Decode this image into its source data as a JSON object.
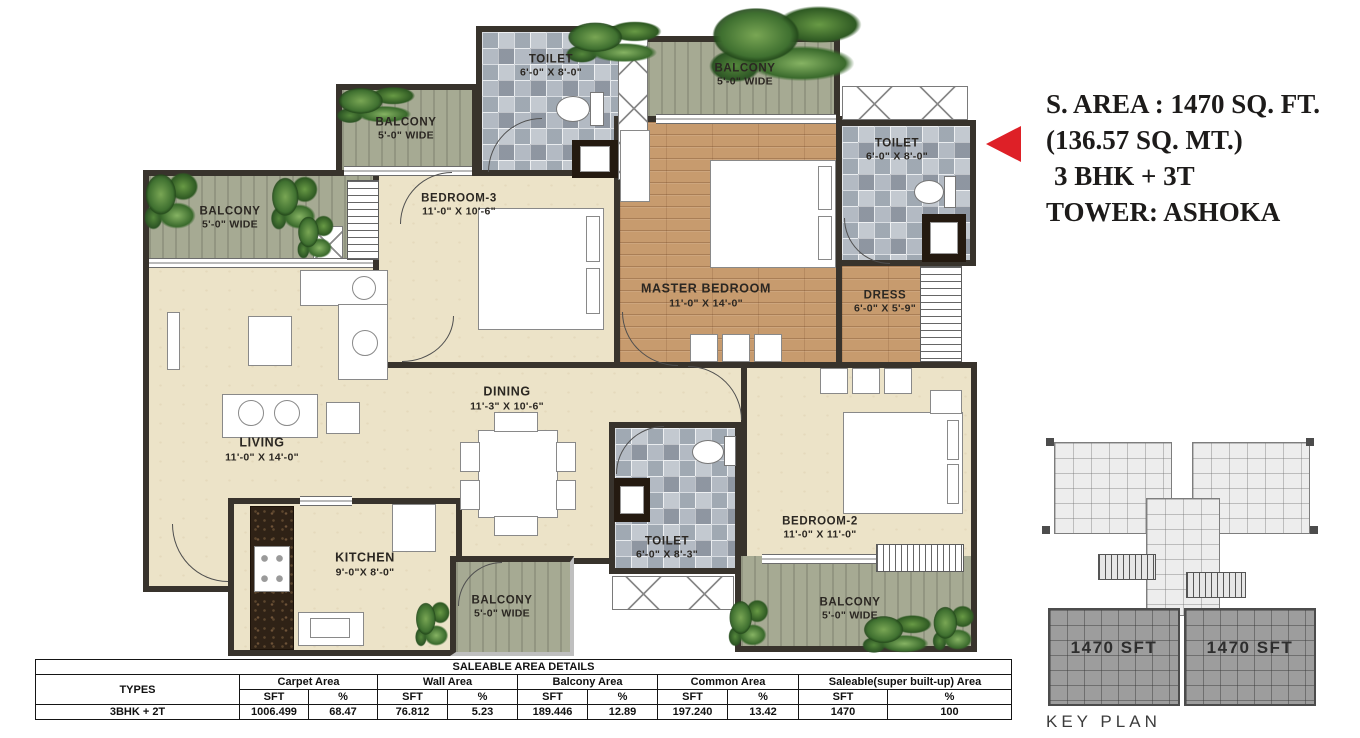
{
  "annotation": {
    "line1": "S. AREA : 1470 SQ. FT.",
    "line2": "(136.57 SQ. MT.)",
    "line3": "3 BHK + 3T",
    "line4": "TOWER: ASHOKA"
  },
  "colors": {
    "accent_red": "#de2027",
    "wall_dark": "#38332c",
    "floor_cream": "#ece3c8",
    "floor_wood": "#c79b6e",
    "balcony_green": "#a6aa93",
    "tile_gray": "#a9b1bb"
  },
  "rooms": {
    "toilet_tl": {
      "name": "TOILET",
      "dims": "6'-0\" X 8'-0\""
    },
    "balcony_top": {
      "name": "BALCONY",
      "dims": "5'-0\" WIDE"
    },
    "toilet_tr": {
      "name": "TOILET",
      "dims": "6'-0\" X 8'-0\""
    },
    "balcony_ul": {
      "name": "BALCONY",
      "dims": "5'-0\" WIDE"
    },
    "balcony_left": {
      "name": "BALCONY",
      "dims": "5'-0\" WIDE"
    },
    "bedroom3": {
      "name": "BEDROOM-3",
      "dims": "11'-0\" X 10'-6\""
    },
    "master": {
      "name": "MASTER BEDROOM",
      "dims": "11'-0\" X 14'-0\""
    },
    "dress": {
      "name": "DRESS",
      "dims": "6'-0\" X 5'-9\""
    },
    "living": {
      "name": "LIVING",
      "dims": "11'-0\" X 14'-0\""
    },
    "dining": {
      "name": "DINING",
      "dims": "11'-3\" X 10'-6\""
    },
    "kitchen": {
      "name": "KITCHEN",
      "dims": "9'-0\"X 8'-0\""
    },
    "toilet_b": {
      "name": "TOILET",
      "dims": "6'-0\" X 8'-3\""
    },
    "bedroom2": {
      "name": "BEDROOM-2",
      "dims": "11'-0\" X 11'-0\""
    },
    "balcony_kitchen": {
      "name": "BALCONY",
      "dims": "5'-0\" WIDE"
    },
    "balcony_bottom": {
      "name": "BALCONY",
      "dims": "5'-0\" WIDE"
    }
  },
  "key_plan": {
    "unit_left_label": "1470 SFT",
    "unit_right_label": "1470 SFT",
    "caption": "KEY PLAN"
  },
  "table": {
    "title": "SALEABLE AREA DETAILS",
    "types_header": "TYPES",
    "group_headers": [
      "Carpet Area",
      "Wall Area",
      "Balcony Area",
      "Common Area",
      "Saleable(super built-up) Area"
    ],
    "sub_headers": [
      "SFT",
      "%"
    ],
    "row": {
      "type": "3BHK + 2T",
      "values": [
        "1006.499",
        "68.47",
        "76.812",
        "5.23",
        "189.446",
        "12.89",
        "197.240",
        "13.42",
        "1470",
        "100"
      ]
    }
  }
}
